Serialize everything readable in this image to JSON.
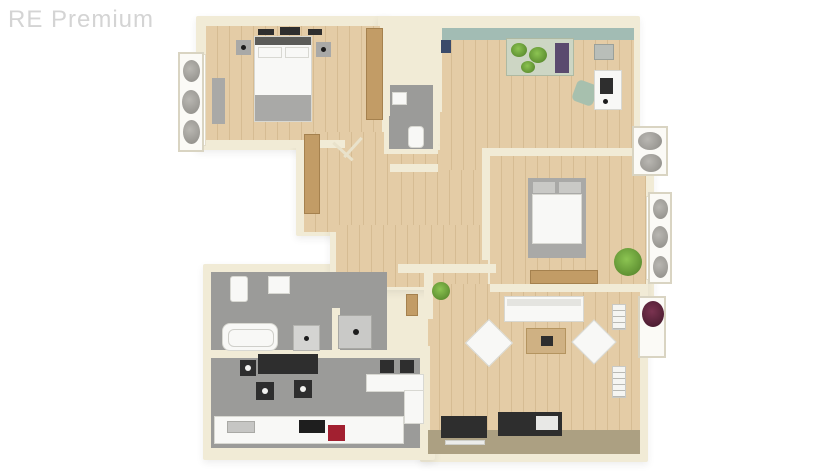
{
  "watermark": {
    "text": "RE Premium"
  },
  "palette": {
    "wall": "#f1ebd6",
    "wood_floor": "#e4cca6",
    "wood_plank_line": "#d6bc93",
    "gray_floor": "#9b9b99",
    "teal_wall": "#a2bcb4",
    "gray_furniture": "#a9a9a7",
    "dark_furniture": "#2e2e2e",
    "wood_furniture": "#c29c66",
    "terrace_strip": "#aca082",
    "red_appliance": "#a22030"
  },
  "plan": {
    "type": "3d-top-down-floor-plan",
    "rooms": [
      {
        "name": "bedroom-1",
        "floor": "wood",
        "furniture": [
          "double-bed",
          "pillows",
          "nightstand-left",
          "nightstand-right",
          "wall-decor",
          "tall-wardrobe",
          "dresser"
        ]
      },
      {
        "name": "office-room",
        "floor": "wood",
        "furniture": [
          "plant-table",
          "purple-cabinet",
          "wall-cabinet",
          "desk",
          "laptop",
          "desk-chair",
          "blue-item"
        ]
      },
      {
        "name": "bedroom-2",
        "floor": "wood",
        "furniture": [
          "double-bed",
          "pillows",
          "bench",
          "potted-plant"
        ]
      },
      {
        "name": "living-room",
        "floor": "wood",
        "furniture": [
          "sofa",
          "armchair-left",
          "armchair-right",
          "coffee-table",
          "tv-sideboard",
          "media-unit",
          "wall-shelf-upper",
          "wall-shelf-lower",
          "potted-plant"
        ]
      },
      {
        "name": "bathroom",
        "floor": "gray",
        "furniture": [
          "bathtub",
          "washbasin",
          "toilet",
          "cabinet",
          "shower"
        ]
      },
      {
        "name": "wc",
        "floor": "gray",
        "furniture": [
          "toilet",
          "washbasin"
        ]
      },
      {
        "name": "kitchen-dining",
        "floor": "gray",
        "furniture": [
          "dining-table",
          "chairs",
          "bar-stools",
          "kitchen-island",
          "counter",
          "sink",
          "cooktop",
          "red-appliance"
        ]
      },
      {
        "name": "hallway",
        "floor": "wood",
        "furniture": [
          "wardrobe",
          "coat-rack",
          "console",
          "potted-plant"
        ]
      }
    ],
    "exterior": [
      "flower-box-left",
      "flower-box-top-right",
      "flower-box-right",
      "balcony-planter"
    ]
  }
}
